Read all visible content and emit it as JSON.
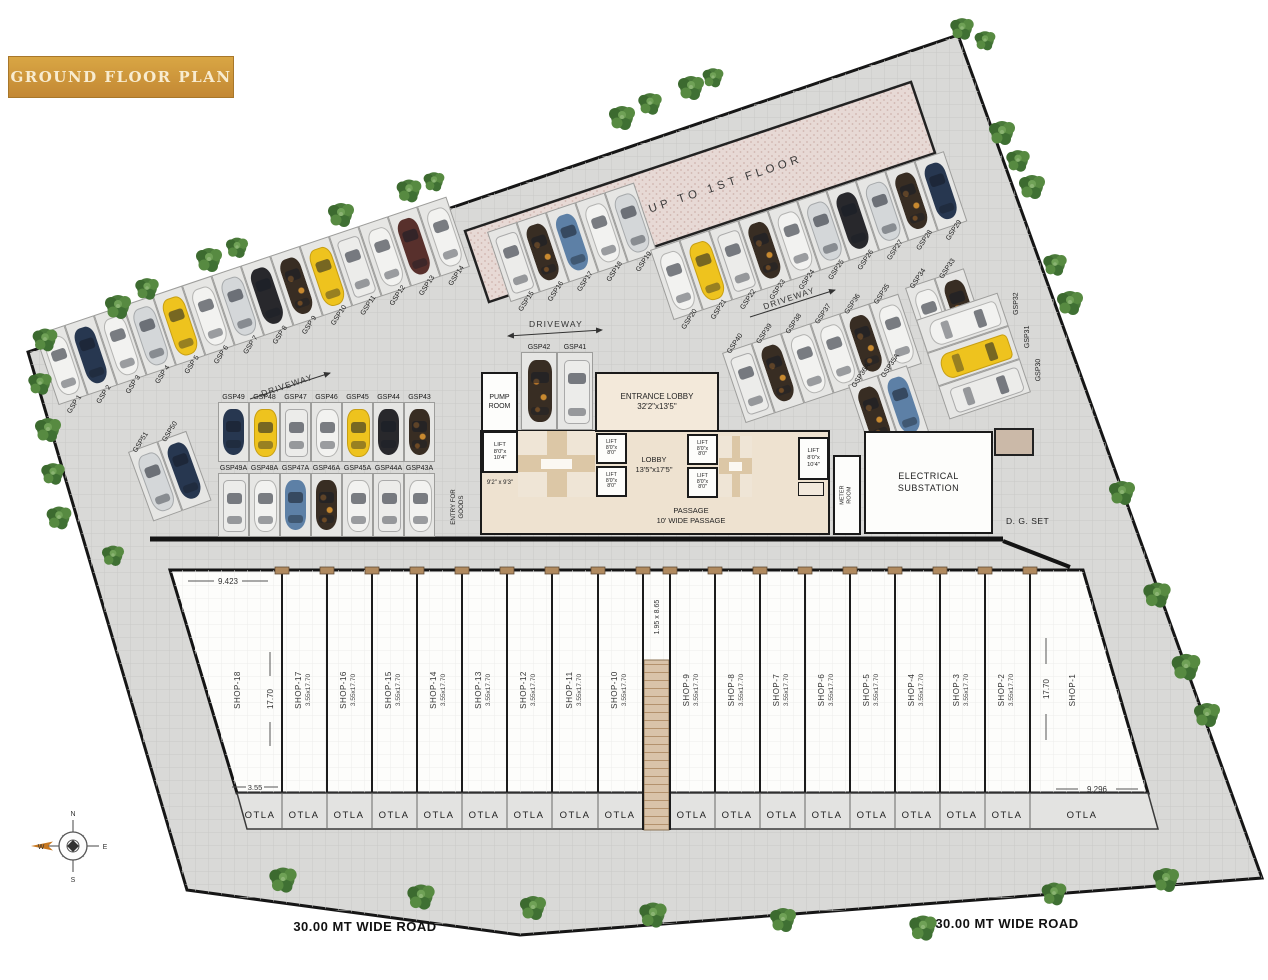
{
  "title": "GROUND FLOOR PLAN",
  "ramp_label": "RAMP UP TO 1ST FLOOR",
  "roads": {
    "left": "30.00 MT WIDE ROAD",
    "right": "30.00 MT WIDE ROAD"
  },
  "driveways": {
    "west": "DRIVEWAY",
    "center": "DRIVEWAY",
    "east": "DRIVEWAY"
  },
  "compass": {
    "n": "N",
    "e": "E",
    "s": "S",
    "w": "W"
  },
  "otla": "OTLA",
  "rooms": {
    "pump_room": "PUMP\nROOM",
    "entrance_lobby": "ENTRANCE LOBBY\n32'2\"x13'5\"",
    "lobby": "LOBBY\n13'5\"x17'5\"",
    "passage": "PASSAGE\n10' WIDE PASSAGE",
    "lift_large": "LIFT\n8'0\"x\n10'4\"",
    "lift_small": "LIFT\n8'0\"x\n8'0\"",
    "room_9x9": "9'2\" x 9'3\"",
    "meter_room": "METER\nROOM",
    "electrical_substation": "ELECTRICAL\nSUBSTATION",
    "dg_set": "D. G. SET",
    "entry_for_goods": "ENTRY FOR\nGOODS"
  },
  "dims": {
    "shop18_top": "9.423",
    "shop18_bottom": "3.55",
    "shop18_depth": "17.70",
    "mid_corridor": "1.95 x 8.65",
    "shop1_depth": "17.70",
    "shop1_bottom": "9.296"
  },
  "shops": [
    {
      "name": "SHOP-18",
      "dim": ""
    },
    {
      "name": "SHOP-17",
      "dim": "3.55x17.70"
    },
    {
      "name": "SHOP-16",
      "dim": "3.55x17.70"
    },
    {
      "name": "SHOP-15",
      "dim": "3.55x17.70"
    },
    {
      "name": "SHOP-14",
      "dim": "3.55x17.70"
    },
    {
      "name": "SHOP-13",
      "dim": "3.55x17.70"
    },
    {
      "name": "SHOP-12",
      "dim": "3.55x17.70"
    },
    {
      "name": "SHOP-11",
      "dim": "3.55x17.70"
    },
    {
      "name": "SHOP-10",
      "dim": "3.55x17.70"
    },
    {
      "name": "SHOP-9",
      "dim": "3.55x17.70"
    },
    {
      "name": "SHOP-8",
      "dim": "3.55x17.70"
    },
    {
      "name": "SHOP-7",
      "dim": "3.55x17.70"
    },
    {
      "name": "SHOP-6",
      "dim": "3.55x17.70"
    },
    {
      "name": "SHOP-5",
      "dim": "3.55x17.70"
    },
    {
      "name": "SHOP-4",
      "dim": "3.55x17.70"
    },
    {
      "name": "SHOP-3",
      "dim": "3.55x17.70"
    },
    {
      "name": "SHOP-2",
      "dim": "3.55x17.70"
    },
    {
      "name": "SHOP-1",
      "dim": ""
    }
  ],
  "parking": {
    "row_top": [
      {
        "label": "GSP 1",
        "car": "white"
      },
      {
        "label": "GSP 2",
        "car": "navy"
      },
      {
        "label": "GSP 3",
        "car": "white"
      },
      {
        "label": "GSP 4",
        "car": "silver"
      },
      {
        "label": "GSP 5",
        "car": "yellow"
      },
      {
        "label": "GSP 6",
        "car": "white"
      },
      {
        "label": "GSP 7",
        "car": "silver"
      },
      {
        "label": "GSP 8",
        "car": "black"
      },
      {
        "label": "GSP 9",
        "car": "camo"
      },
      {
        "label": "GSP10",
        "car": "yellow"
      },
      {
        "label": "GSP11",
        "car": "van"
      },
      {
        "label": "GSP12",
        "car": "white"
      },
      {
        "label": "GSP13",
        "car": "maroon"
      },
      {
        "label": "GSP14",
        "car": "white"
      }
    ],
    "row_ramp_a": [
      {
        "label": "GSP15",
        "car": "van"
      },
      {
        "label": "GSP16",
        "car": "camo"
      },
      {
        "label": "GSP17",
        "car": "blue"
      },
      {
        "label": "GSP18",
        "car": "white"
      },
      {
        "label": "GSP19",
        "car": "silver"
      }
    ],
    "row_ramp_b": [
      {
        "label": "GSP20",
        "car": "white"
      },
      {
        "label": "GSP21",
        "car": "yellow"
      },
      {
        "label": "GSP22",
        "car": "van"
      },
      {
        "label": "GSP23",
        "car": "camo"
      },
      {
        "label": "GSP24",
        "car": "white"
      },
      {
        "label": "GSP25",
        "car": "silver"
      },
      {
        "label": "GSP26",
        "car": "black"
      },
      {
        "label": "GSP27",
        "car": "silver"
      },
      {
        "label": "GSP28",
        "car": "camo"
      },
      {
        "label": "GSP29",
        "car": "navy"
      }
    ],
    "row_mid": [
      {
        "label": "GSP40",
        "car": "van"
      },
      {
        "label": "GSP39",
        "car": "camo"
      },
      {
        "label": "GSP38",
        "car": "white"
      },
      {
        "label": "GSP37",
        "car": "white"
      },
      {
        "label": "GSP36",
        "car": "camo"
      },
      {
        "label": "GSP35",
        "car": "white"
      }
    ],
    "row_mid_a": [
      {
        "label": "GSP36A",
        "car": "camo"
      },
      {
        "label": "GSP35A",
        "car": "blue"
      }
    ],
    "pair_ne": [
      {
        "label": "GSP34",
        "car": "white"
      },
      {
        "label": "GSP33",
        "car": "camo"
      }
    ],
    "col_east": [
      {
        "label": "GSP32",
        "car": "white"
      },
      {
        "label": "GSP31",
        "car": "yellow"
      },
      {
        "label": "GSP30",
        "car": "van"
      }
    ],
    "row_center": [
      {
        "label": "GSP49",
        "car": "navy"
      },
      {
        "label": "GSP48",
        "car": "yellow"
      },
      {
        "label": "GSP47",
        "car": "van"
      },
      {
        "label": "GSP46",
        "car": "white"
      },
      {
        "label": "GSP45",
        "car": "yellow"
      },
      {
        "label": "GSP44",
        "car": "black"
      },
      {
        "label": "GSP43",
        "car": "camo"
      }
    ],
    "row_center_a": [
      {
        "label": "GSP49A",
        "car": "van"
      },
      {
        "label": "GSP48A",
        "car": "white"
      },
      {
        "label": "GSP47A",
        "car": "blue"
      },
      {
        "label": "GSP46A",
        "car": "camo"
      },
      {
        "label": "GSP45A",
        "car": "white"
      },
      {
        "label": "GSP44A",
        "car": "van"
      },
      {
        "label": "GSP43A",
        "car": "white"
      }
    ],
    "pair_pump": [
      {
        "label": "GSP42",
        "car": "camo"
      },
      {
        "label": "GSP41",
        "car": "van"
      }
    ],
    "pair_west": [
      {
        "label": "GSP51",
        "car": "silver"
      },
      {
        "label": "GSP50",
        "car": "navy"
      }
    ]
  },
  "colors": {
    "accent_gold": "#cf9a3f",
    "site_gray": "#d9d9d7",
    "floor_beige": "#eee2d0",
    "ramp_pink": "#e7d9d5",
    "stair_tan": "#d9c3a9"
  }
}
